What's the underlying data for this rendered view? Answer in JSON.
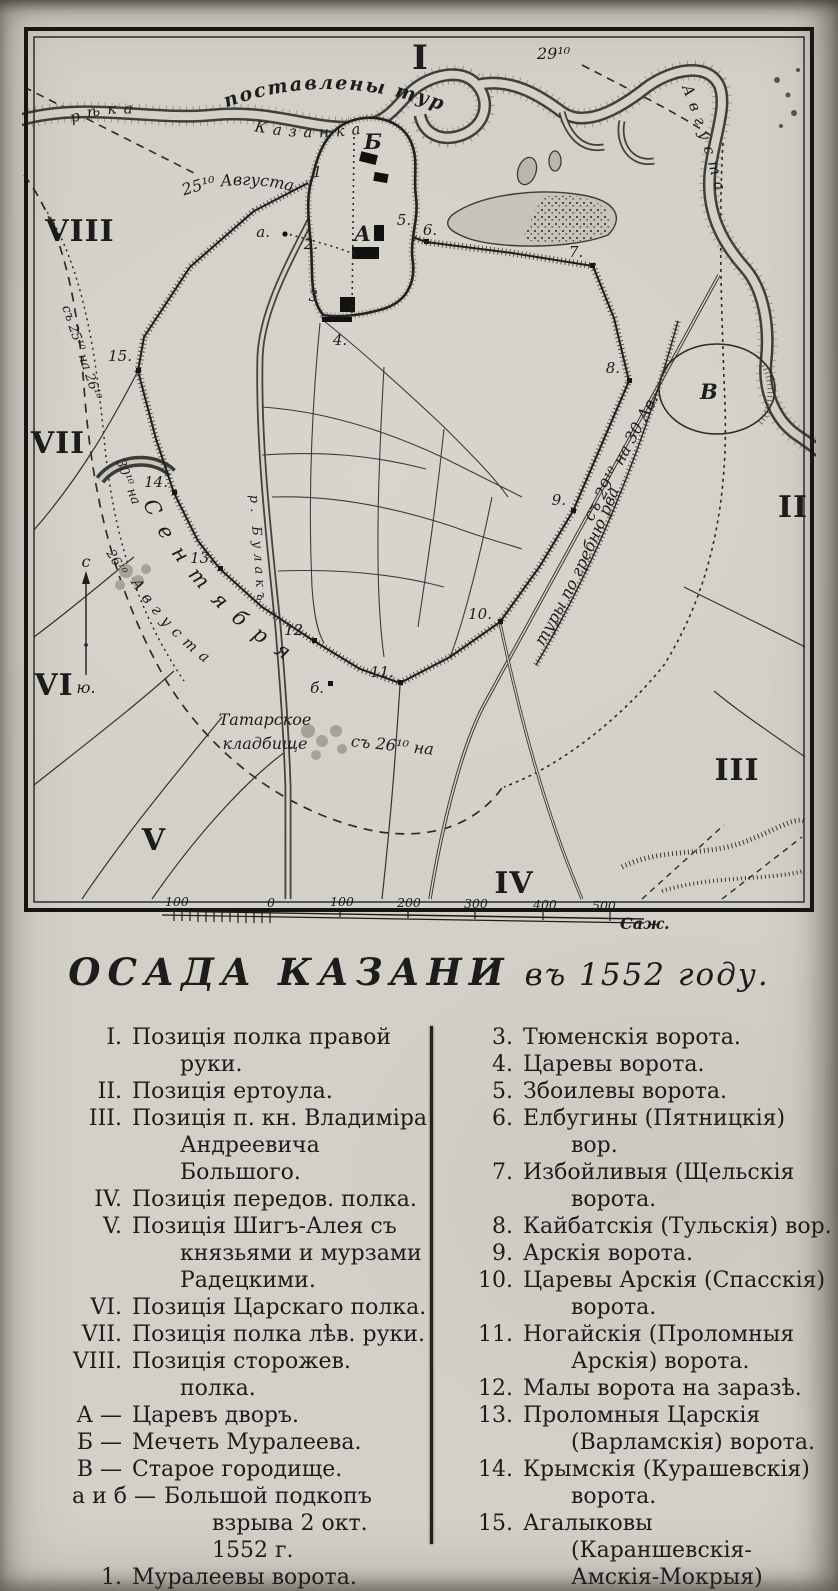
{
  "title": {
    "main": "ОСАДА КАЗАНИ",
    "tail": "въ 1552 году."
  },
  "map": {
    "numerals": {
      "n1": "I",
      "n2": "II",
      "n3": "III",
      "n4": "IV",
      "n5": "V",
      "n6": "VI",
      "n7": "VII",
      "n8": "VIII"
    },
    "marks": {
      "A": "А",
      "B": "Б",
      "V": "В",
      "mine_a": "а.",
      "mine_b": "б."
    },
    "gates": {
      "g1": "1",
      "g2": "2.",
      "g3": "3",
      "g4": "4.",
      "g5": "5.",
      "g6": "6.",
      "g7": "7.",
      "g8": "8.",
      "g9": "9.",
      "g10": "10.",
      "g11": "11.",
      "g12": "12.",
      "g13": "13.",
      "g14": "14.",
      "g15": "15."
    },
    "labels": {
      "postavleny_tury": "поставлены туры",
      "reka": "рѣка",
      "kazanka": "Казанка",
      "date_29": "29¹⁰",
      "avgusta_right": "Августа",
      "date_25_avg": "25¹⁰ Августа",
      "west_dates": "съ 25¹⁰ на 26¹⁰",
      "date_30": "30¹⁰ на",
      "date_26": "26¹⁰",
      "sentyabrya": "Сентября",
      "avgusta_sw": "Августа",
      "s_26_na": "съ 26¹⁰ на",
      "tatar_cem_line1": "Татарское",
      "tatar_cem_line2": "кладбище",
      "tury_grebnyu": "туры по гребню рва",
      "s_29_na_30": "съ 29¹⁰ на 30 Ав.",
      "bulak": "р. Булакъ",
      "compass_n": "с",
      "compass_s": "ю."
    },
    "scale": {
      "ticks": [
        "100",
        "0",
        "100",
        "200",
        "300",
        "400",
        "500"
      ],
      "unit": "Саж."
    }
  },
  "legend": {
    "left": [
      {
        "style": "roman",
        "num": "I.",
        "text": "Позиція полка правой руки."
      },
      {
        "style": "roman",
        "num": "II.",
        "text": "Позиція ертоула."
      },
      {
        "style": "roman",
        "num": "III.",
        "text": "Позиція п. кн. Владиміра Андреевича Большого."
      },
      {
        "style": "roman",
        "num": "IV.",
        "text": "Позиція передов. полка."
      },
      {
        "style": "roman",
        "num": "V.",
        "text": "Позиція Шигъ-Алея съ князьями и мурзами Радецкими."
      },
      {
        "style": "roman",
        "num": "VI.",
        "text": "Позиція Царскаго полка."
      },
      {
        "style": "roman",
        "num": "VII.",
        "text": "Позиція полка лѣв. руки."
      },
      {
        "style": "roman",
        "num": "VIII.",
        "text": "Позиція сторожев. полка."
      },
      {
        "style": "letter",
        "num": "А —",
        "text": "Царевъ дворъ."
      },
      {
        "style": "letter",
        "num": "Б —",
        "text": "Мечеть Муралеева."
      },
      {
        "style": "letter",
        "num": "В —",
        "text": "Старое городище."
      },
      {
        "style": "letter-wide",
        "num": "а и б —",
        "text": "Большой подкопъ взрыва 2 окт. 1552 г."
      },
      {
        "style": "digit",
        "num": "1.",
        "text": "Муралеевы ворота."
      },
      {
        "style": "digit",
        "num": "2.",
        "text": "Аталыковы ворота."
      }
    ],
    "right": [
      {
        "style": "digit",
        "num": "3.",
        "text": "Тюменскія ворота."
      },
      {
        "style": "digit",
        "num": "4.",
        "text": "Царевы ворота."
      },
      {
        "style": "digit",
        "num": "5.",
        "text": "Збоилевы ворота."
      },
      {
        "style": "digit",
        "num": "6.",
        "text": "Елбугины (Пятницкія) вор."
      },
      {
        "style": "digit",
        "num": "7.",
        "text": "Избойливыя (Щельскія ворота."
      },
      {
        "style": "digit",
        "num": "8.",
        "text": "Кайбатскія (Тульскія) вор."
      },
      {
        "style": "digit",
        "num": "9.",
        "text": "Арскія ворота."
      },
      {
        "style": "digit",
        "num": "10.",
        "text": "Царевы Арскія (Спасскія) ворота."
      },
      {
        "style": "digit",
        "num": "11.",
        "text": "Ногайскія (Проломныя Арскія) ворота."
      },
      {
        "style": "digit",
        "num": "12.",
        "text": "Малы ворота на заразѣ."
      },
      {
        "style": "digit",
        "num": "13.",
        "text": "Проломныя Царскія (Варламскія) ворота."
      },
      {
        "style": "digit",
        "num": "14.",
        "text": "Крымскія (Курашевскія) ворота."
      },
      {
        "style": "digit",
        "num": "15.",
        "text": "Агалыковы (Караншевскія-Амскія-Мокрыя) ворота."
      }
    ]
  }
}
